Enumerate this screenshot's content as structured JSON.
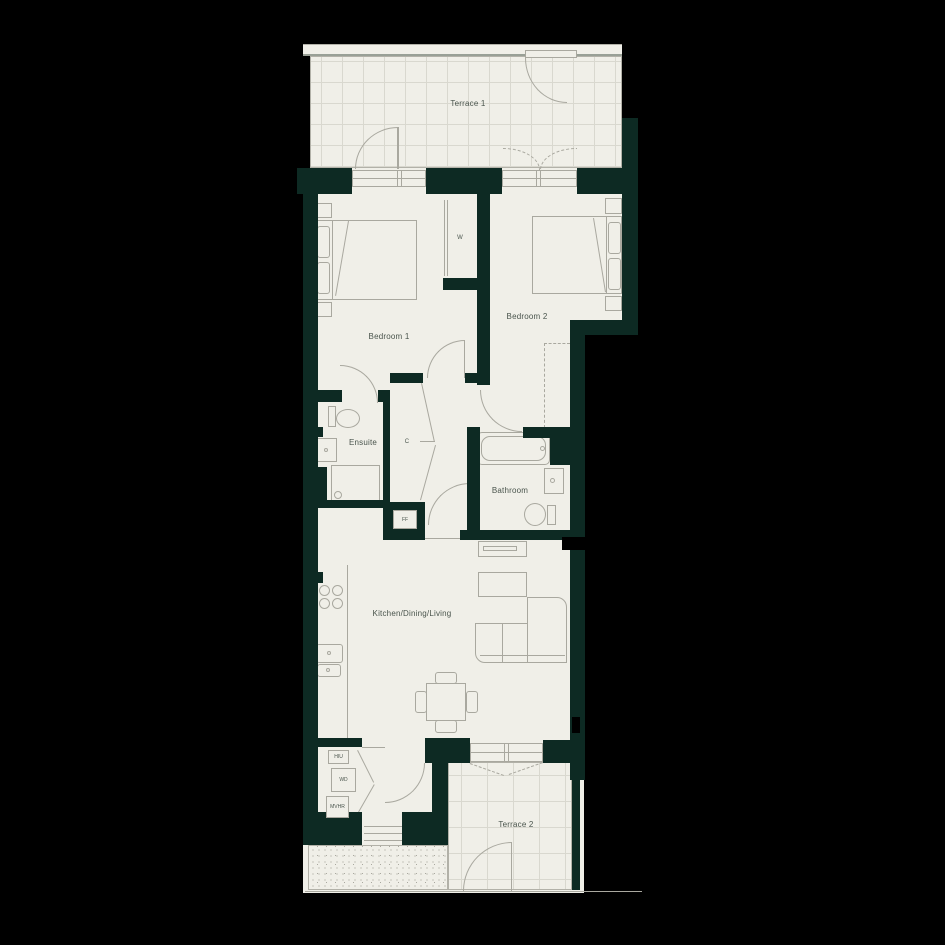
{
  "labels": {
    "terrace1": "Terrace 1",
    "bedroom1": "Bedroom 1",
    "wardrobe": "W",
    "bedroom2": "Bedroom 2",
    "ensuite": "Ensuite",
    "cupboard": "C",
    "bathroom": "Bathroom",
    "fridge_freezer": "FF",
    "kitchen": "Kitchen/Dining/Living",
    "terrace2": "Terrace 2",
    "hiu": "HIU",
    "wd": "WD",
    "mvhr": "MVHR"
  },
  "colors": {
    "bg": "#000000",
    "wall": "#0d2a23",
    "floor": "#f0efe8",
    "line": "#a9a89f",
    "border": "#b2b1a8",
    "grid": "#d9d8cf",
    "parapet": "#99a096",
    "text": "#49544c"
  }
}
